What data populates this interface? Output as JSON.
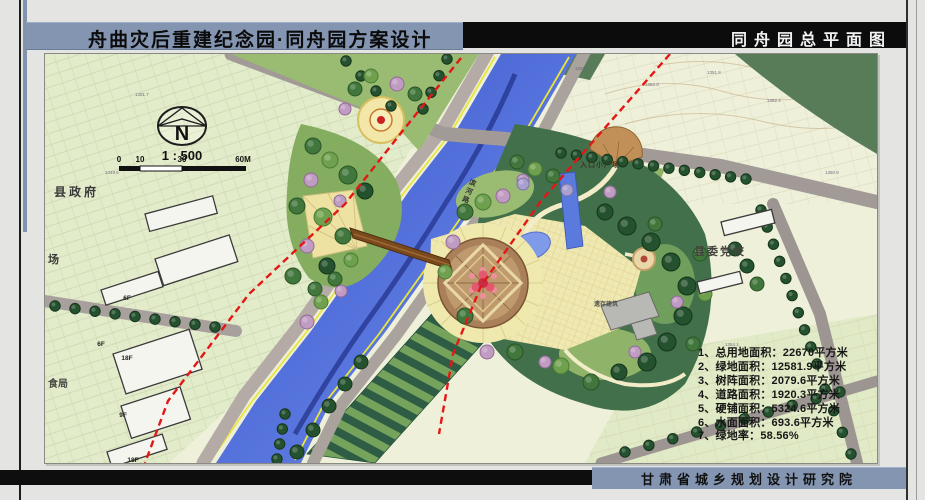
{
  "header": {
    "main_title": "舟曲灾后重建纪念园·同舟园方案设计",
    "drawing_title": "同舟园总平面图"
  },
  "footer": {
    "institute": "甘肃省城乡规划设计研究院"
  },
  "compass": {
    "north": "N",
    "scale": "1 : 500",
    "ticks": [
      "0",
      "10",
      "30",
      "60M"
    ]
  },
  "stats": {
    "items": [
      "1、总用地面积：22670平方米",
      "2、绿地面积：12581.9平方米",
      "3、树阵面积：2079.6平方米",
      "4、道路面积：1920.3平方米",
      "5、硬铺面积：5324.6平方米",
      "6、水面面积：693.6平方米",
      "7、绿地率：58.56%"
    ]
  },
  "labels": {
    "county_government": "县政府",
    "party_school": "县委党校",
    "entrance_plaza": "入口小广场",
    "preserved_building": "遗存建筑",
    "riverside_road": "滨河路",
    "square_fragment": "场",
    "bureau_fragment": "食局",
    "buildings": [
      "6F",
      "6F",
      "18F",
      "9F",
      "18F"
    ]
  },
  "elevations": [
    "1353.4",
    "1352.0",
    "1351.8",
    "1352.4",
    "1350.9",
    "1351.7",
    "1349.6",
    "1354.1"
  ],
  "colors": {
    "accent_bar": "#8495b1",
    "river_blue": "#4a66d4",
    "axis_red": "#e51616",
    "park_dark_green": "#41704a",
    "plaza_yellow": "#efe8b0"
  }
}
